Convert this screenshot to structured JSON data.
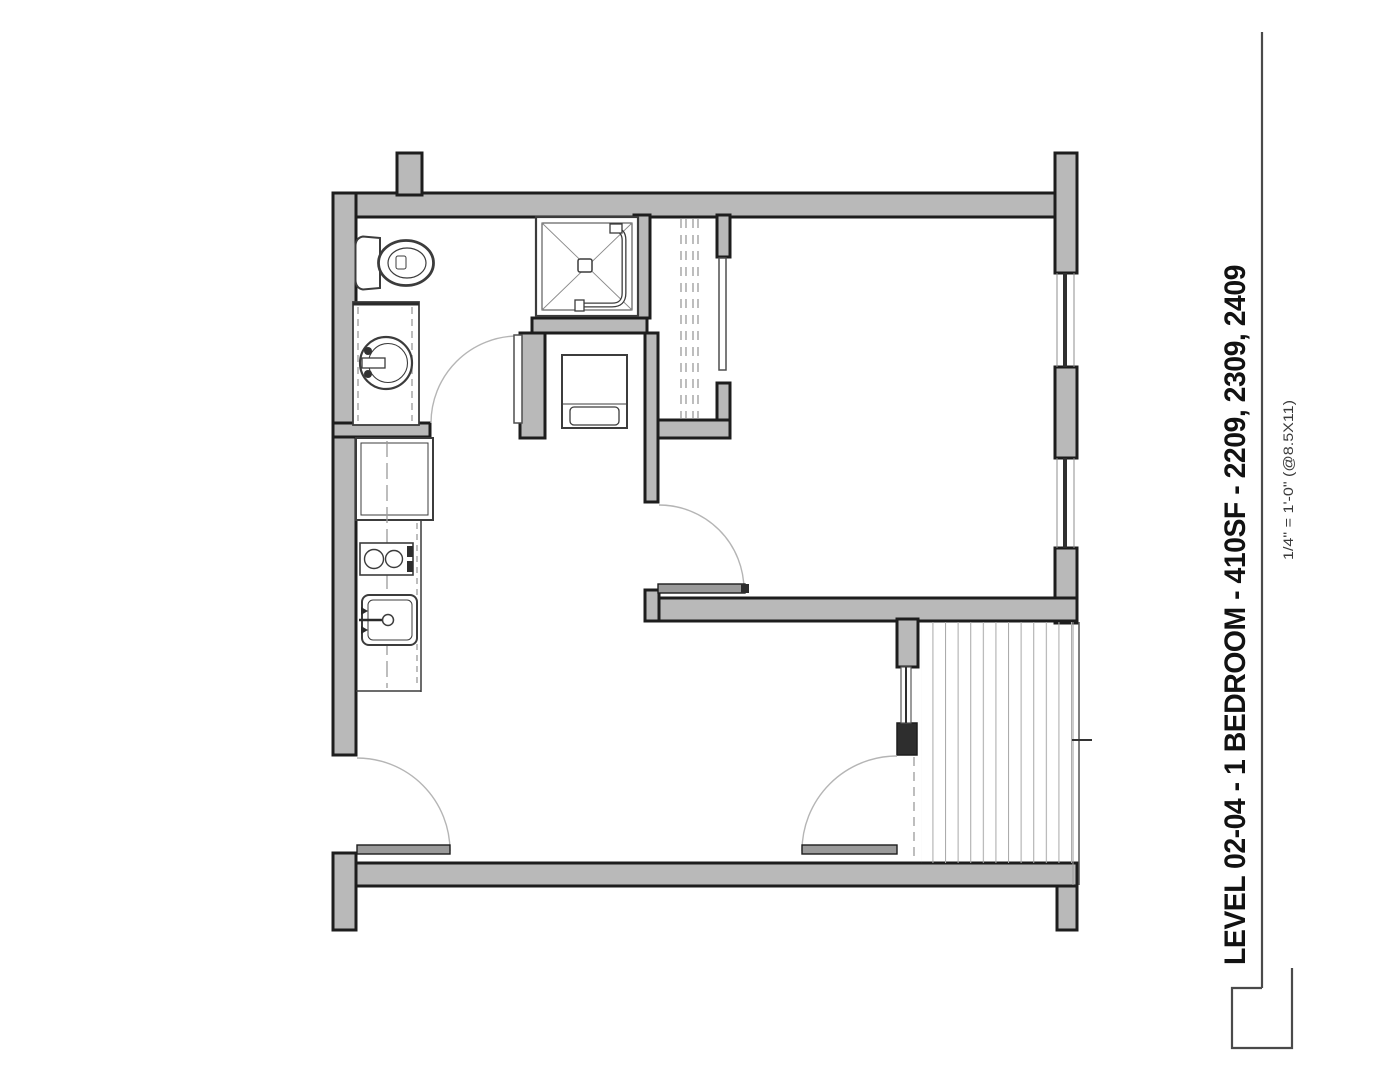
{
  "title_block": {
    "title": "LEVEL 02-04 - 1 BEDROOM - 410SF - 2209, 2309, 2409",
    "scale_note": "1/4\" = 1'-0\" (@8.5X11)"
  },
  "colors": {
    "background": "#ffffff",
    "wall_fill": "#b9b9b9",
    "wall_edge": "#1d1d1d",
    "interior_dark": "#2e2e2e",
    "door_leaf": "#9a9a9a",
    "arc": "#b5b5b5",
    "fixture_line": "#3c3c3c",
    "fixture_light": "#8a8a8a",
    "dash": "#9a9a9a",
    "glazing": "#303030",
    "deck_hatch": "#ababab",
    "title_text": "#121212",
    "scale_text": "#3a3a3a",
    "titleblock_line": "#4a4a4a"
  }
}
